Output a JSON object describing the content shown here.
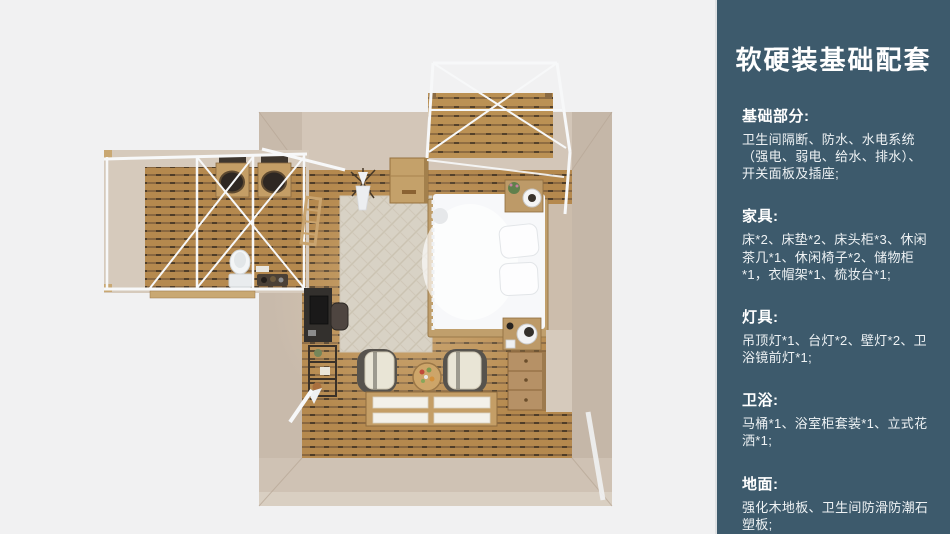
{
  "palette": {
    "background": "#f1f1f2",
    "sidebar_bg": "#3d5a6c",
    "sidebar_edge": "#dfe1e3",
    "wall_top": "#d3c6b8",
    "wall_left": "#c8baab",
    "wall_right": "#c5b7a8",
    "wall_bottom": "#cfc2b4",
    "floor_wood": "#b5894e",
    "deck_wood": "#bb9154",
    "rug": "#d8d2c5",
    "bed_white": "#f7f8fa",
    "frame_white": "#f7f8f9",
    "furniture_wood": "#c49e66",
    "desk_dark": "#33302d"
  },
  "sidebar": {
    "title": "软硬装基础配套",
    "sections": [
      {
        "heading": "基础部分:",
        "body": "卫生间隔断、防水、水电系统（强电、弱电、给水、排水）、开关面板及插座;"
      },
      {
        "heading": "家具:",
        "body": "床*2、床垫*2、床头柜*3、休闲茶几*1、休闲椅子*2、储物柜*1，衣帽架*1、梳妆台*1;"
      },
      {
        "heading": "灯具:",
        "body": "吊顶灯*1、台灯*2、壁灯*2、卫浴镜前灯*1;"
      },
      {
        "heading": "卫浴:",
        "body": "马桶*1、浴室柜套装*1、立式花洒*1;"
      },
      {
        "heading": "地面:",
        "body": "强化木地板、卫生间防滑防潮石塑板;"
      }
    ]
  }
}
